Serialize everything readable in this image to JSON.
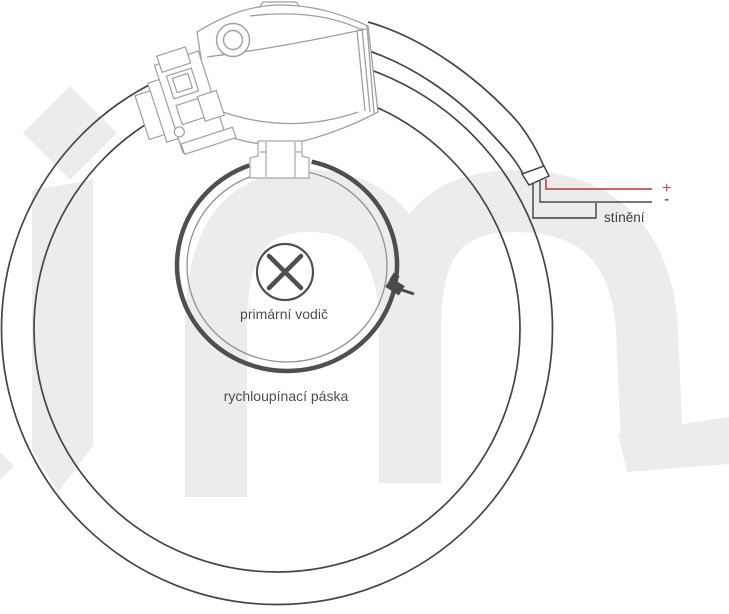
{
  "diagram": {
    "kind": "technical wiring diagram of a flexible current-sensor coil clamped around a conductor",
    "labels": {
      "primary_conductor": "primární vodič",
      "quick_release_strap": "rychloupínací páska",
      "shielding": "stínění",
      "positive": "+",
      "negative": "-"
    },
    "watermark_text": "im",
    "symbols": {
      "conductor_cross": "circle-with-x current-into-page symbol",
      "grommet": "concentric-circles cable grommet",
      "buckle": "dark strap buckle with pin"
    },
    "colors": {
      "positive_wire": "#c0504d",
      "dark_lines": "#454545",
      "strap": "#4f4f4f",
      "housing_lines": "#9aa0a6",
      "watermark": "#ececec",
      "label_text": "#4d4d4d"
    }
  }
}
